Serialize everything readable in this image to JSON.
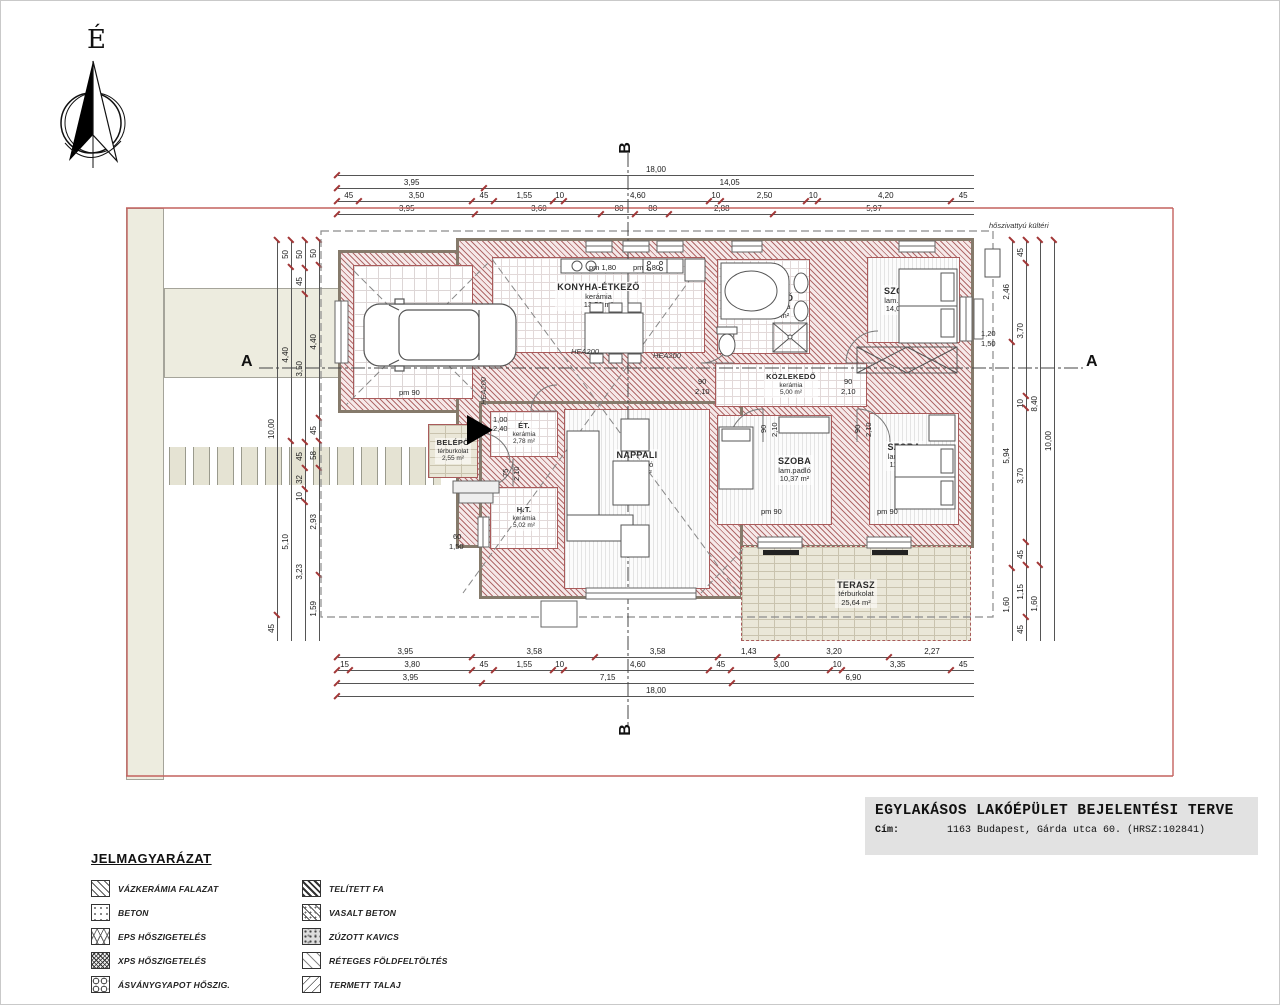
{
  "meta": {
    "north_label": "É"
  },
  "title_block": {
    "title": "EGYLAKÁSOS LAKÓÉPÜLET BEJELENTÉSI TERVE",
    "address_label": "Cím:",
    "address": "1163 Budapest, Gárda utca 60. (HRSZ:102841)"
  },
  "sections": {
    "a": "A",
    "b": "B"
  },
  "rooms": [
    {
      "name": "GARAZS",
      "floor": "kerámia",
      "area": "20,52 m²"
    },
    {
      "name": "KONYHA-ÉTKEZŐ",
      "floor": "kerámia",
      "area": "13,56 m²"
    },
    {
      "name": "FÜRDŐ",
      "floor": "Kerámia",
      "area": "7,37 m²"
    },
    {
      "name": "SZOBA",
      "floor": "lam.padló",
      "area": "14,00 m²"
    },
    {
      "name": "KÖZLEKEDŐ",
      "floor": "kerámia",
      "area": "5,00 m²"
    },
    {
      "name": "ÉT.",
      "floor": "kerámia",
      "area": "2,78 m²"
    },
    {
      "name": "BELÉPŐ",
      "floor": "térburkolat",
      "area": "2,55 m²"
    },
    {
      "name": "H.T.",
      "floor": "kerámia",
      "area": "5,02 m²"
    },
    {
      "name": "NAPPALI",
      "floor": "lam.padló",
      "area": "28,84 m²"
    },
    {
      "name": "SZOBA",
      "floor": "lam.padló",
      "area": "10,37 m²"
    },
    {
      "name": "SZOBA",
      "floor": "lam.padló",
      "area": "11,69 m²"
    },
    {
      "name": "TERASZ",
      "floor": "térburkolat",
      "area": "25,64 m²"
    }
  ],
  "dims": {
    "top": [
      [
        "18,00"
      ],
      [
        "3,95",
        "14,05"
      ],
      [
        "45",
        "3,50",
        "45",
        "1,55",
        "10",
        "4,60",
        "10",
        "2,50",
        "10",
        "4,20",
        "45"
      ],
      [
        "3,95",
        "3,60",
        "80",
        "80",
        "2,88",
        "5,97"
      ]
    ],
    "bottom": [
      [
        "3,95",
        "3,58",
        "3,58",
        "1,43",
        "3,20",
        "2,27"
      ],
      [
        "15",
        "3,80",
        "45",
        "1,55",
        "10",
        "4,60",
        "45",
        "3,00",
        "10",
        "3,35",
        "45"
      ],
      [
        "3,95",
        "7,15",
        "6,90"
      ],
      [
        "18,00"
      ]
    ],
    "left": [
      [
        "10,00",
        "45"
      ],
      [
        "50",
        "4,40",
        "5,10"
      ],
      [
        "50",
        "45",
        "3,50",
        "45",
        "32",
        "10",
        "3,23"
      ],
      [
        "50",
        "4,40",
        "45",
        "58",
        "2,93",
        "1,59"
      ]
    ],
    "right": [
      [
        "2,46",
        "5,94",
        "1,60"
      ],
      [
        "45",
        "3,70",
        "10",
        "3,70",
        "45",
        "1,15",
        "45"
      ],
      [
        "8,40",
        "1,60"
      ],
      [
        "10,00"
      ]
    ]
  },
  "plan_labels": [
    {
      "t": "hőszivattyú kültéri",
      "x": 988,
      "y": 220,
      "i": 1
    },
    {
      "t": "HEA200",
      "x": 570,
      "y": 346,
      "i": 1
    },
    {
      "t": "HEA200",
      "x": 652,
      "y": 350,
      "i": 1
    },
    {
      "t": "HEA200",
      "x": 478,
      "y": 404,
      "r": 1,
      "i": 1
    },
    {
      "t": "pm 90",
      "x": 398,
      "y": 387
    },
    {
      "t": "pm 90",
      "x": 760,
      "y": 506
    },
    {
      "t": "pm 90",
      "x": 876,
      "y": 506
    },
    {
      "t": "pm 1,80",
      "x": 588,
      "y": 262
    },
    {
      "t": "pm 1,80",
      "x": 632,
      "y": 262
    },
    {
      "t": "90",
      "x": 697,
      "y": 376
    },
    {
      "t": "2,10",
      "x": 694,
      "y": 386
    },
    {
      "t": "90",
      "x": 843,
      "y": 376
    },
    {
      "t": "2,10",
      "x": 840,
      "y": 386
    },
    {
      "t": "90",
      "x": 758,
      "y": 432,
      "r": 1
    },
    {
      "t": "2,10",
      "x": 769,
      "y": 436,
      "r": 1
    },
    {
      "t": "90",
      "x": 852,
      "y": 432,
      "r": 1
    },
    {
      "t": "2,10",
      "x": 863,
      "y": 436,
      "r": 1
    },
    {
      "t": "75",
      "x": 500,
      "y": 476,
      "r": 1
    },
    {
      "t": "2,10",
      "x": 511,
      "y": 480,
      "r": 1
    },
    {
      "t": "1,00",
      "x": 492,
      "y": 414
    },
    {
      "t": "2,40",
      "x": 492,
      "y": 423
    },
    {
      "t": "60",
      "x": 452,
      "y": 531
    },
    {
      "t": "1,50",
      "x": 448,
      "y": 541
    },
    {
      "t": "1,20",
      "x": 980,
      "y": 328
    },
    {
      "t": "1,50",
      "x": 980,
      "y": 338
    }
  ],
  "legend": {
    "heading": "JELMAGYARÁZAT",
    "left": [
      {
        "label": "VÁZKERÁMIA FALAZAT",
        "pattern": "diag"
      },
      {
        "label": "BETON",
        "pattern": "beton"
      },
      {
        "label": "EPS HŐSZIGETELÉS",
        "pattern": "eps"
      },
      {
        "label": "XPS HŐSZIGETELÉS",
        "pattern": "xps"
      },
      {
        "label": "ÁSVÁNYGYAPOT HŐSZIG.",
        "pattern": "mineral"
      }
    ],
    "right": [
      {
        "label": "TELÍTETT FA",
        "pattern": "wood"
      },
      {
        "label": "VASALT BETON",
        "pattern": "vasalt"
      },
      {
        "label": "ZÚZOTT KAVICS",
        "pattern": "kavics"
      },
      {
        "label": "RÉTEGES FÖLDFELTÖLTÉS",
        "pattern": "layers"
      },
      {
        "label": "TERMETT TALAJ",
        "pattern": "talaj"
      }
    ]
  }
}
